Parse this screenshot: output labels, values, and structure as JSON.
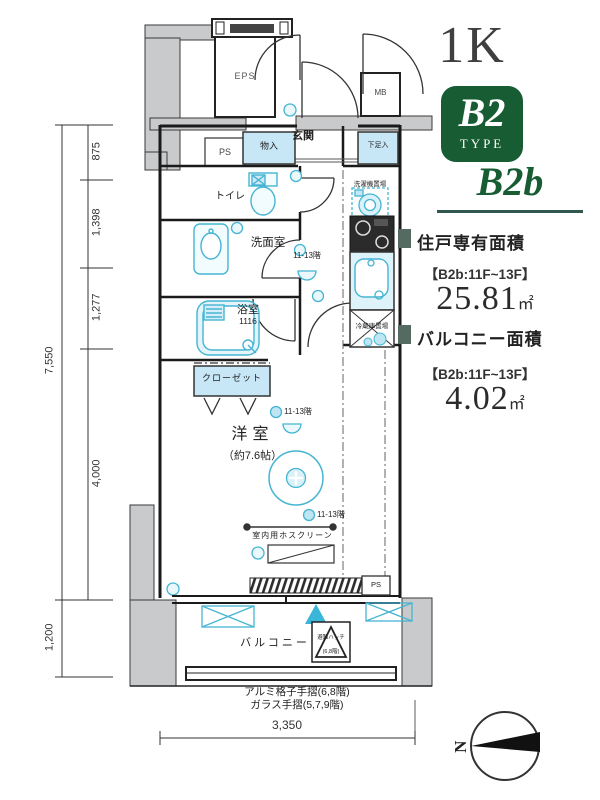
{
  "header": {
    "layout": "1K",
    "badge_main": "B2",
    "badge_sub": "TYPE",
    "subtype": "B2b"
  },
  "areas": {
    "unit_title": "住戸専有面積",
    "unit_floors": "【B2b:11F~13F】",
    "unit_value": "25.81",
    "unit_unit": "㎡",
    "balcony_title": "バルコニー面積",
    "balcony_floors": "【B2b:11F~13F】",
    "balcony_value": "4.02",
    "balcony_unit": "㎡"
  },
  "plan": {
    "rooms": {
      "eps": "EPS",
      "ps_top": "PS",
      "genkan": "玄関",
      "mb": "MB",
      "monoire": "物入",
      "getabako": "下足入",
      "toilet": "トイレ",
      "senmenshitsu": "洗面室",
      "bathroom": "浴室",
      "bath_size": "1116",
      "washer": "洗濯機置場",
      "fridge": "冷蔵庫置場",
      "closet": "クローゼット",
      "main_room": "洋室",
      "main_room_size": "（約7.6帖）",
      "balcony": "バルコニー",
      "hatch_line1": "避難ハッチ",
      "hatch_line2": "(6,8階)",
      "ps_balcony": "PS"
    },
    "notes": {
      "floors_a": "11-13階",
      "floors_b": "11-13階",
      "floors_c": "11-13階",
      "hoscreen": "室内用ホスクリーン",
      "rail_1": "アルミ格子手摺(6,8階)",
      "rail_2": "ガラス手摺(5,7,9階)"
    }
  },
  "dimensions": {
    "v_875": "875",
    "v_1398": "1,398",
    "v_1277": "1,277",
    "v_total": "7,550",
    "v_4000": "4,000",
    "v_1200": "1,200",
    "h_3350": "3,350"
  },
  "compass": {
    "label": "N"
  },
  "colors": {
    "badge_green": "#175c33",
    "subtype_green": "#175c33",
    "underline": "#31584e",
    "bullet": "#556b62",
    "fixture_cyan": "#45b5d2",
    "storage_blue": "#c8e7f6",
    "concrete_gray": "#c9cacc"
  }
}
